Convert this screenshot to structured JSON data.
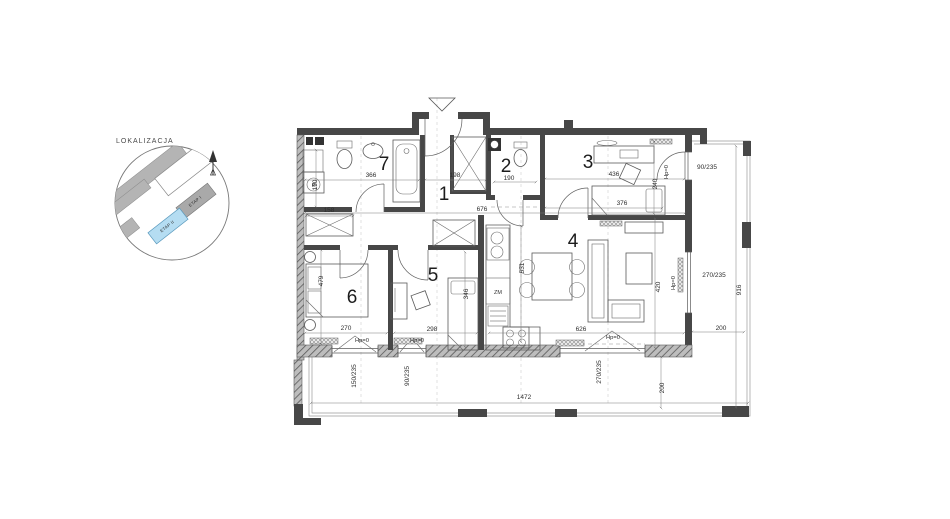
{
  "minimap": {
    "title": "LOKALIZACJA",
    "etap1": "ETAP I",
    "etap2": "ETAP II",
    "highlight_color": "#b5ddf2"
  },
  "plan": {
    "rooms": [
      {
        "t": "1",
        "x": 444,
        "y": 200
      },
      {
        "t": "2",
        "x": 506,
        "y": 172
      },
      {
        "t": "3",
        "x": 588,
        "y": 168
      },
      {
        "t": "4",
        "x": 573,
        "y": 247
      },
      {
        "t": "5",
        "x": 433,
        "y": 281
      },
      {
        "t": "6",
        "x": 352,
        "y": 303
      },
      {
        "t": "7",
        "x": 384,
        "y": 170
      }
    ],
    "dims": [
      {
        "t": "366",
        "x": 371,
        "y": 177
      },
      {
        "t": "190",
        "x": 317,
        "y": 185,
        "r": -90
      },
      {
        "t": "158",
        "x": 329,
        "y": 212
      },
      {
        "t": "198",
        "x": 455,
        "y": 177
      },
      {
        "t": "676",
        "x": 482,
        "y": 211
      },
      {
        "t": "190",
        "x": 509,
        "y": 180
      },
      {
        "t": "436",
        "x": 614,
        "y": 176
      },
      {
        "t": "240",
        "x": 657,
        "y": 184,
        "r": -90
      },
      {
        "t": "376",
        "x": 622,
        "y": 205
      },
      {
        "t": "531",
        "x": 524,
        "y": 268,
        "r": -90
      },
      {
        "t": "626",
        "x": 581,
        "y": 331
      },
      {
        "t": "420",
        "x": 660,
        "y": 287,
        "r": -90
      },
      {
        "t": "298",
        "x": 432,
        "y": 331
      },
      {
        "t": "346",
        "x": 468,
        "y": 294,
        "r": -90
      },
      {
        "t": "479",
        "x": 323,
        "y": 281,
        "r": -90
      },
      {
        "t": "270",
        "x": 346,
        "y": 330
      },
      {
        "t": "1472",
        "x": 524,
        "y": 399
      },
      {
        "t": "916",
        "x": 741,
        "y": 290,
        "r": -90
      },
      {
        "t": "200",
        "x": 721,
        "y": 330
      },
      {
        "t": "200",
        "x": 664,
        "y": 388,
        "r": -90
      }
    ],
    "openings": [
      {
        "t": "90/235",
        "x": 707,
        "y": 169
      },
      {
        "t": "270/235",
        "x": 714,
        "y": 277
      },
      {
        "t": "150/235",
        "x": 356,
        "y": 376,
        "r": -90
      },
      {
        "t": "90/235",
        "x": 409,
        "y": 376,
        "r": -90
      },
      {
        "t": "270/235",
        "x": 601,
        "y": 372,
        "r": -90
      }
    ],
    "floor_levels": [
      {
        "t": "Hp=0",
        "x": 362,
        "y": 342
      },
      {
        "t": "Hp=0",
        "x": 417,
        "y": 342
      },
      {
        "t": "Hp=0",
        "x": 613,
        "y": 339
      },
      {
        "t": "Hp=0",
        "x": 675,
        "y": 283,
        "r": -90
      },
      {
        "t": "Hp=0",
        "x": 668,
        "y": 172,
        "r": -90
      }
    ],
    "appliances": [
      {
        "t": "ZM",
        "x": 498,
        "y": 294
      },
      {
        "t": "P",
        "x": 313.5,
        "y": 187
      }
    ]
  }
}
